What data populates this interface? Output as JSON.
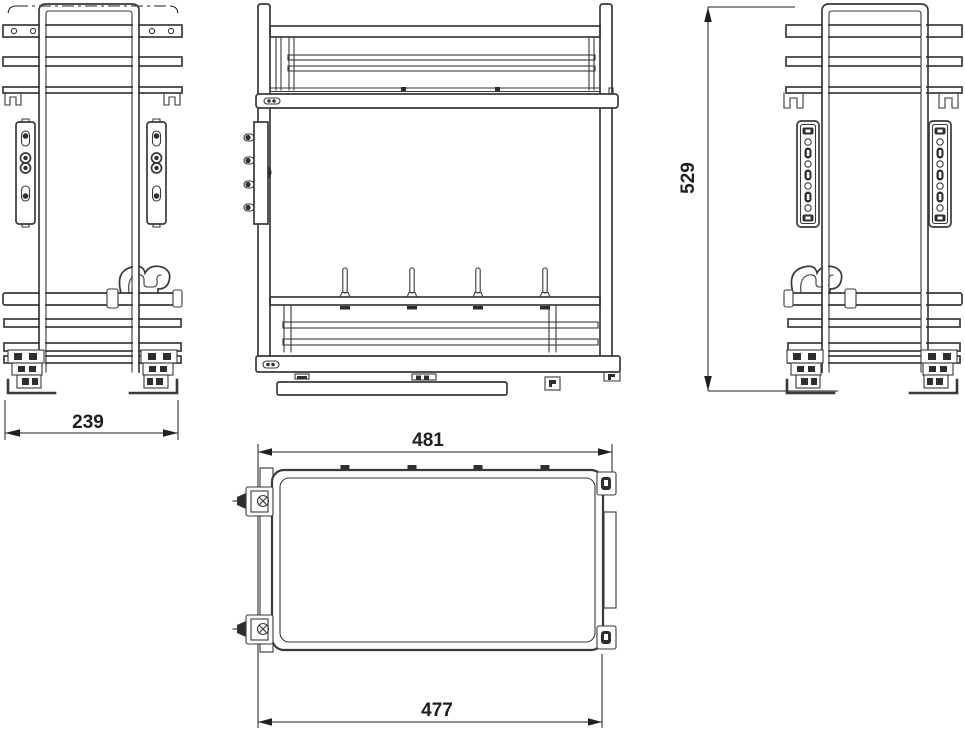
{
  "drawing": {
    "background": "#ffffff",
    "line_color": "#3a3a3a",
    "fill_color": "#2e2e2e",
    "dimension_color": "#1f1f1f"
  },
  "dimensions": {
    "side_view_width": "239",
    "overall_height": "529",
    "top_view_rail_width": "481",
    "top_view_tray_width": "477"
  }
}
